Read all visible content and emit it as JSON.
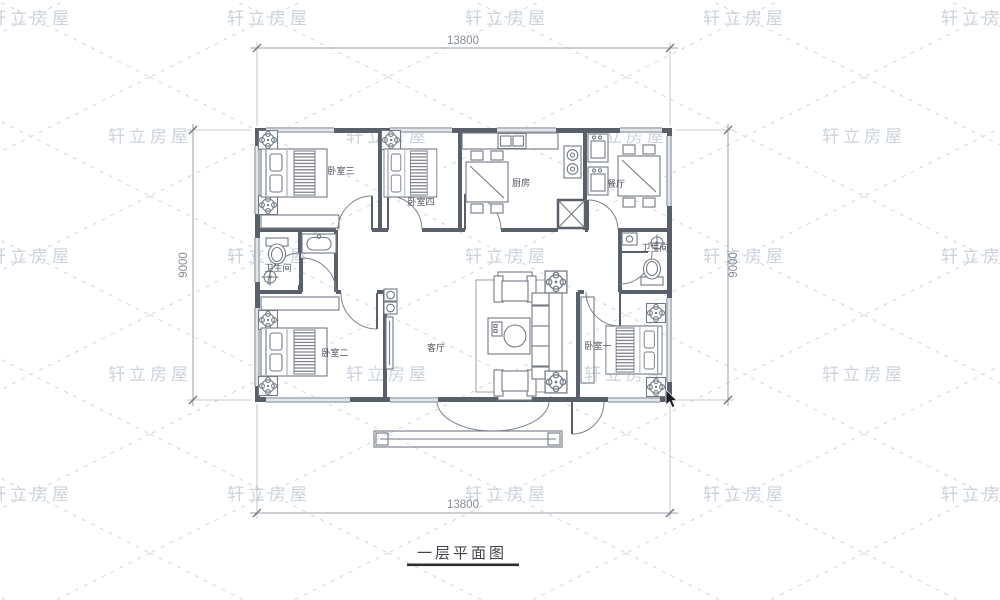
{
  "watermark": {
    "text": "轩立房屋"
  },
  "plan": {
    "title": "一层平面图",
    "dims": {
      "width_top": "13800",
      "width_bottom": "13800",
      "height_left": "9000",
      "height_right": "9000"
    },
    "rooms": {
      "bedroom3": {
        "label": "卧室三"
      },
      "bedroom4": {
        "label": "卧室四"
      },
      "kitchen": {
        "label": "厨房"
      },
      "dining": {
        "label": "餐厅"
      },
      "bath_left": {
        "label": "卫生间"
      },
      "bath_right": {
        "label": "卫生间"
      },
      "bedroom2": {
        "label": "卧室二"
      },
      "bedroom1": {
        "label": "卧室一"
      },
      "living": {
        "label": "客厅"
      }
    },
    "colors": {
      "wall": "#5a6069",
      "furniture": "#737a84",
      "window": "#b6bcc4",
      "dimension": "#9aa1aa",
      "watermark": "#ccd3dc",
      "label": "#4c5158"
    }
  }
}
